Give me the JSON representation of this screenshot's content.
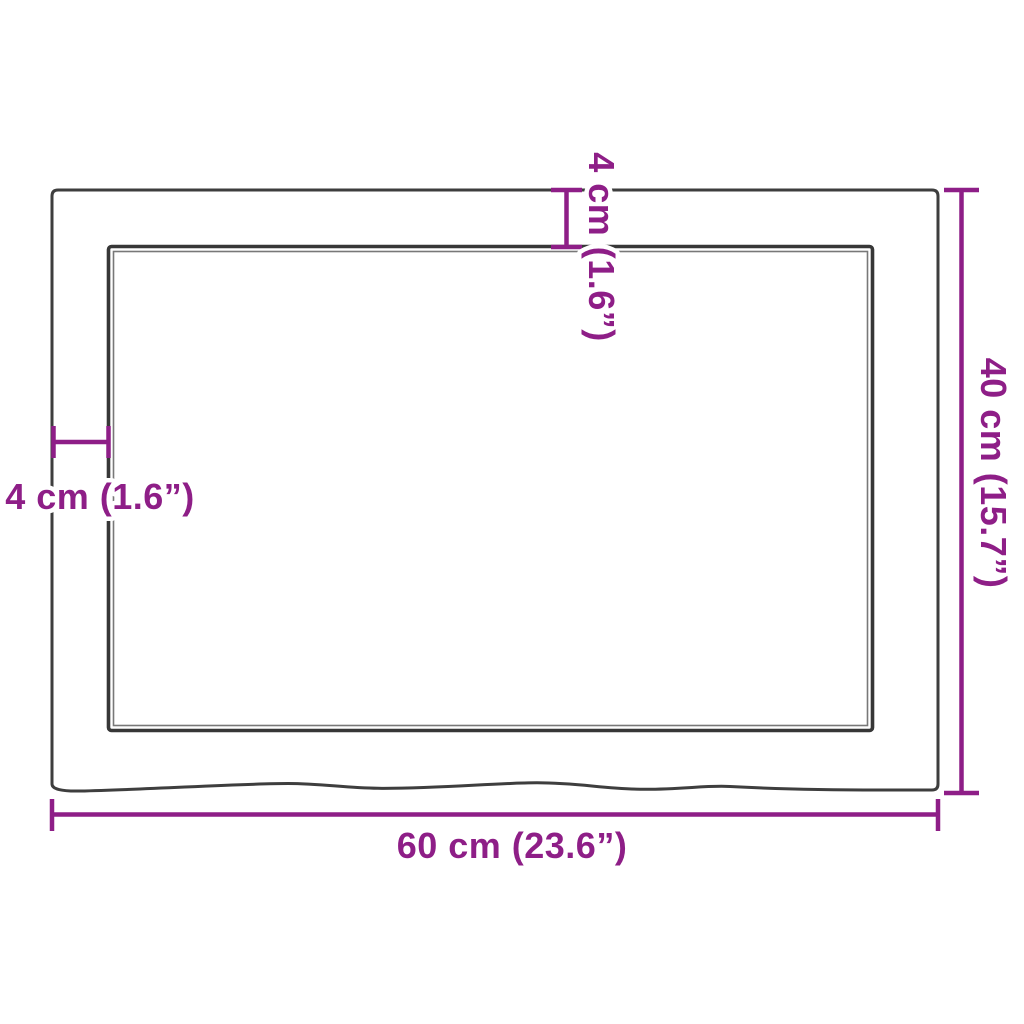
{
  "diagram": {
    "kind": "product-dimension-drawing",
    "colors": {
      "dimension_accent": "#8E1E87",
      "outline": "#3E3E3E",
      "background": "#FFFFFF"
    },
    "dimensions": {
      "width": {
        "value": "60 cm (23.6”)"
      },
      "height": {
        "value": "40 cm (15.7”)"
      },
      "top_edge_thickness": {
        "value": "4 cm (1.6”)"
      },
      "side_edge_thickness": {
        "value": "4 cm (1.6”)"
      }
    }
  }
}
